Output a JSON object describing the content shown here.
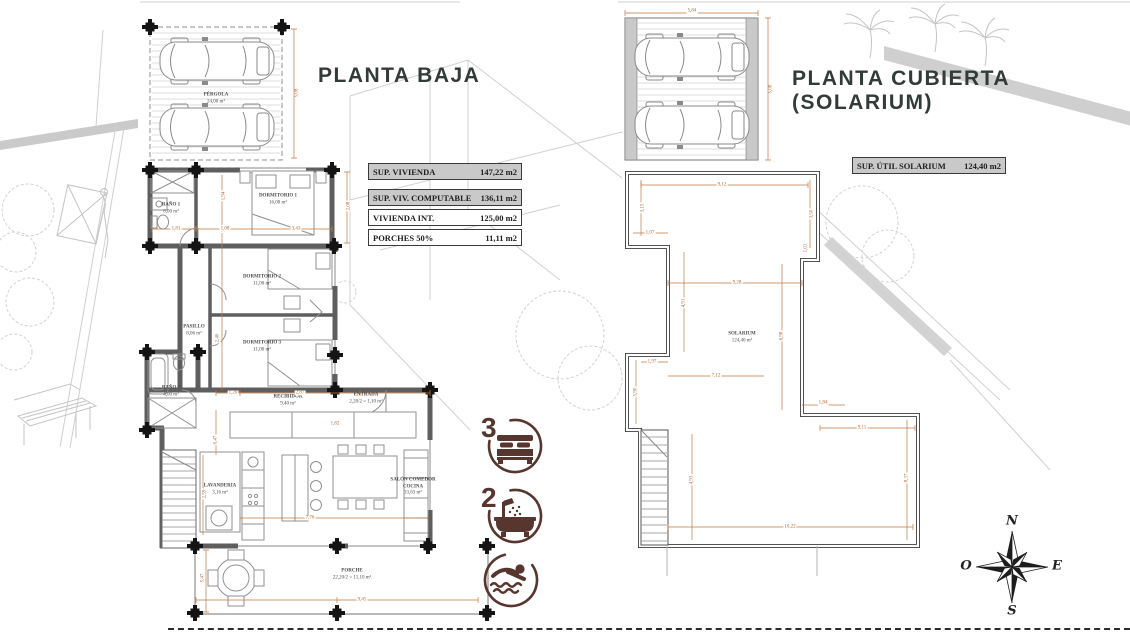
{
  "left_plan": {
    "title": "PLANTA BAJA",
    "area_table": [
      {
        "label": "SUP. VIVIENDA",
        "value": "147,22 m2",
        "shaded": true
      },
      {
        "label": "SUP. VIV. COMPUTABLE",
        "value": "136,11 m2",
        "shaded": true
      },
      {
        "label": "VIVIENDA INT.",
        "value": "125,00 m2",
        "shaded": false
      },
      {
        "label": "PORCHES 50%",
        "value": "11,11 m2",
        "shaded": false
      }
    ],
    "rooms": [
      {
        "name": "PÉRGOLA",
        "area": "24,00 m²",
        "x": 216,
        "y": 99
      },
      {
        "name": "BAÑO 1",
        "area": "6,00 m²",
        "x": 171,
        "y": 209
      },
      {
        "name": "DORMITORIO 1",
        "area": "16,00 m²",
        "x": 278,
        "y": 200
      },
      {
        "name": "DORMITORIO 2",
        "area": "11,00 m²",
        "x": 262,
        "y": 281
      },
      {
        "name": "DORMITORIO 3",
        "area": "11,00 m²",
        "x": 262,
        "y": 347
      },
      {
        "name": "PASILLO",
        "area": "8,06 m²",
        "x": 194,
        "y": 331
      },
      {
        "name": "BAÑO 2",
        "area": "4,00 m²",
        "x": 171,
        "y": 392
      },
      {
        "name": "RECIBIDOR",
        "area": "9,40 m²",
        "x": 288,
        "y": 401
      },
      {
        "name": "ENTRADA",
        "area": "2,20/2 = 1,10 m²",
        "x": 366,
        "y": 399
      },
      {
        "name": "LAVANDERIA",
        "area": "3,16 m²",
        "x": 220,
        "y": 490
      },
      {
        "name": "SALÓN COMEDOR COCINA",
        "area": "33,63 m²",
        "x": 413,
        "y": 487
      },
      {
        "name": "PORCHE",
        "area": "22,20/2 = 11,10 m²",
        "x": 352,
        "y": 575
      }
    ],
    "dims": [
      {
        "t": "5,08",
        "x": 297,
        "y": 93,
        "v": 1
      },
      {
        "t": "1,81",
        "x": 176,
        "y": 229,
        "v": 0
      },
      {
        "t": "1,08",
        "x": 225,
        "y": 229,
        "v": 0
      },
      {
        "t": "3,43",
        "x": 296,
        "y": 229,
        "v": 0
      },
      {
        "t": "2,08",
        "x": 349,
        "y": 206,
        "v": 1
      },
      {
        "t": "1,94",
        "x": 224,
        "y": 196,
        "v": 1
      },
      {
        "t": "2,40",
        "x": 218,
        "y": 338,
        "v": 1
      },
      {
        "t": "1,20",
        "x": 233,
        "y": 393,
        "v": 0
      },
      {
        "t": "2,87",
        "x": 300,
        "y": 393,
        "v": 0
      },
      {
        "t": "1,82",
        "x": 335,
        "y": 424,
        "v": 0
      },
      {
        "t": "0,47",
        "x": 216,
        "y": 440,
        "v": 1
      },
      {
        "t": "2,59",
        "x": 205,
        "y": 494,
        "v": 1
      },
      {
        "t": "7,76",
        "x": 310,
        "y": 518,
        "v": 0
      },
      {
        "t": "5,47",
        "x": 203,
        "y": 578,
        "v": 1
      },
      {
        "t": "9,45",
        "x": 362,
        "y": 600,
        "v": 0
      }
    ]
  },
  "right_plan": {
    "title": "PLANTA CUBIERTA\n(SOLARIUM)",
    "area_table": [
      {
        "label": "SUP. ÚTIL SOLARIUM",
        "value": "124,40 m2",
        "shaded": true
      }
    ],
    "rooms": [
      {
        "name": "SOLARIUM",
        "area": "124,40 m²",
        "x": 742,
        "y": 338
      }
    ],
    "dims": [
      {
        "t": "5,84",
        "x": 692,
        "y": 11,
        "v": 0
      },
      {
        "t": "5,08",
        "x": 771,
        "y": 89,
        "v": 1
      },
      {
        "t": "9,12",
        "x": 722,
        "y": 185,
        "v": 0
      },
      {
        "t": "3,15",
        "x": 643,
        "y": 208,
        "v": 1
      },
      {
        "t": "1,07",
        "x": 650,
        "y": 233,
        "v": 0
      },
      {
        "t": "3,50",
        "x": 812,
        "y": 214,
        "v": 1
      },
      {
        "t": "1,01",
        "x": 806,
        "y": 248,
        "v": 1
      },
      {
        "t": "9,28",
        "x": 737,
        "y": 283,
        "v": 0
      },
      {
        "t": "4,91",
        "x": 684,
        "y": 303,
        "v": 1
      },
      {
        "t": "6,98",
        "x": 782,
        "y": 336,
        "v": 1
      },
      {
        "t": "1,97",
        "x": 652,
        "y": 362,
        "v": 0
      },
      {
        "t": "7,12",
        "x": 716,
        "y": 376,
        "v": 0
      },
      {
        "t": "5,90",
        "x": 636,
        "y": 392,
        "v": 1
      },
      {
        "t": "1,84",
        "x": 823,
        "y": 403,
        "v": 0
      },
      {
        "t": "9,11",
        "x": 862,
        "y": 428,
        "v": 0
      },
      {
        "t": "4,93",
        "x": 692,
        "y": 480,
        "v": 1
      },
      {
        "t": "8,37",
        "x": 907,
        "y": 478,
        "v": 1
      },
      {
        "t": "10,22",
        "x": 790,
        "y": 527,
        "v": 0
      }
    ]
  },
  "badges": {
    "bedrooms": "3",
    "bathrooms": "2"
  },
  "compass": {
    "north": "N",
    "east": "E",
    "south": "S",
    "west": "O"
  },
  "colors": {
    "accent_brown": "#56362e",
    "dimension_orange": "#b4672e",
    "title_dark": "#323b37"
  }
}
